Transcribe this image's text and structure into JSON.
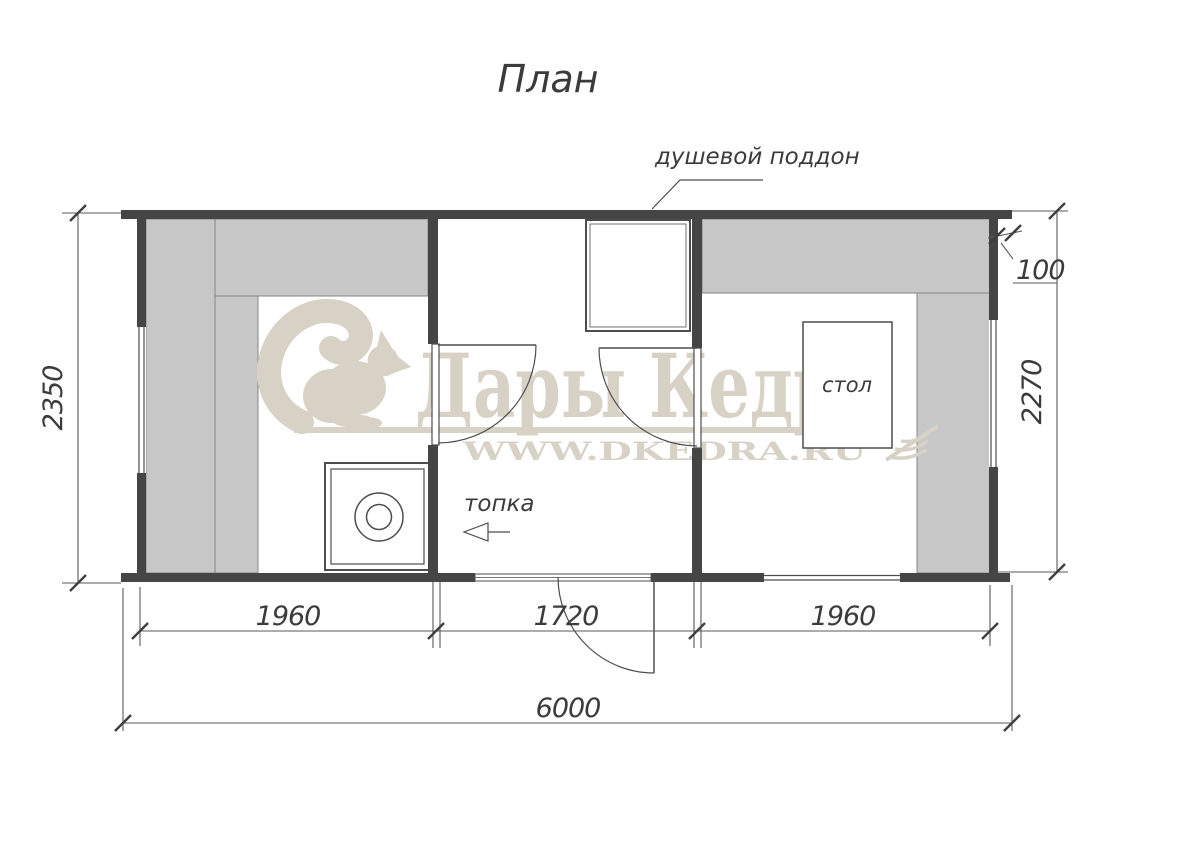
{
  "title": "План",
  "labels": {
    "shower_tray": "душевой поддон",
    "firebox": "топка",
    "table": "стол"
  },
  "dimensions": {
    "left_height": "2350",
    "right_height": "2270",
    "wall_offset": "100",
    "bottom_left": "1960",
    "bottom_middle": "1720",
    "bottom_right": "1960",
    "total_width": "6000"
  },
  "watermark": {
    "brand": "Дары Кедра",
    "website": "WWW.DKEDRA.RU"
  },
  "colors": {
    "wall": "#454545",
    "bench_fill": "#c7c7c7",
    "line": "#4d4d4d",
    "dim_text": "#3b3b3b",
    "watermark": "#d8d1c6",
    "background": "#ffffff"
  }
}
